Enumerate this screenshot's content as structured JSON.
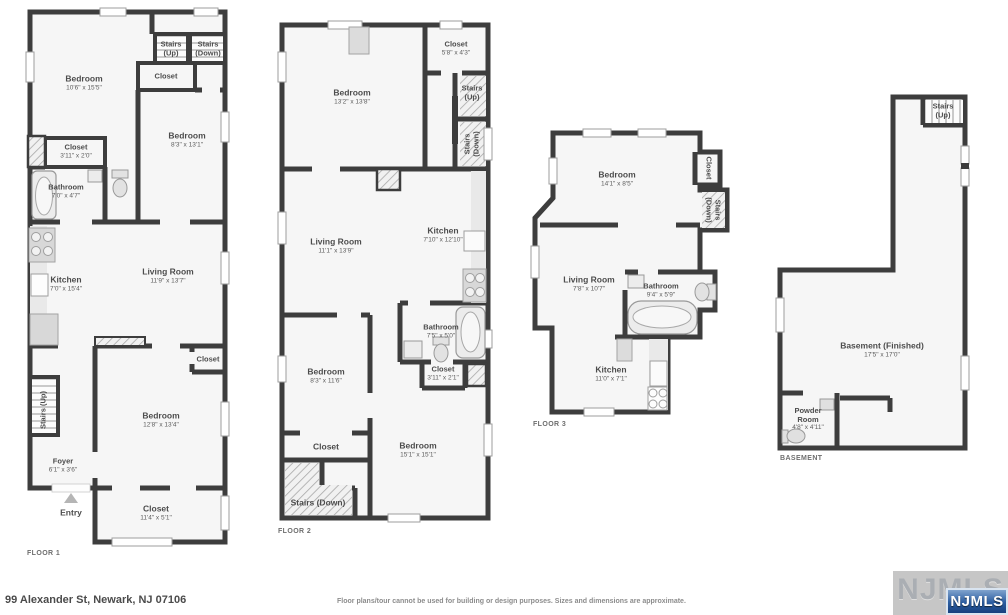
{
  "footer": {
    "address": "99 Alexander St, Newark, NJ 07106",
    "disclaimer": "Floor plans/tour cannot be used for building or design purposes. Sizes and dimensions are approximate.",
    "watermark": "NJMLS",
    "badge": "NJMLS"
  },
  "colors": {
    "wall": "#3d3d3d",
    "room_fill": "#f6f6f6",
    "badge_blue": "#2a5ca0",
    "watermark_gray": "#c6c6c6"
  },
  "floors": {
    "floor1": {
      "label": "FLOOR 1",
      "rooms": {
        "bedroom1": {
          "name": "Bedroom",
          "dims": "10'6\" x 15'5\""
        },
        "stairs_up_top": {
          "line1": "Stairs",
          "line2": "(Up)"
        },
        "stairs_down_top": {
          "line1": "Stairs",
          "line2": "(Down)"
        },
        "closet_top": {
          "name": "Closet"
        },
        "bedroom2": {
          "name": "Bedroom",
          "dims": "8'3\" x 13'1\""
        },
        "closet_left": {
          "name": "Closet",
          "dims": "3'11\" x 2'0\""
        },
        "bathroom": {
          "name": "Bathroom",
          "dims": "7'0\" x 4'7\""
        },
        "kitchen": {
          "name": "Kitchen",
          "dims": "7'0\" x 15'4\""
        },
        "living": {
          "name": "Living Room",
          "dims": "11'9\" x 13'7\""
        },
        "closet_mid": {
          "name": "Closet"
        },
        "stairs_up_side": {
          "name": "Stairs (Up)"
        },
        "bedroom3": {
          "name": "Bedroom",
          "dims": "12'8\" x 13'4\""
        },
        "foyer": {
          "name": "Foyer",
          "dims": "6'1\" x 3'6\""
        },
        "entry": {
          "name": "Entry"
        },
        "closet_bottom": {
          "name": "Closet",
          "dims": "11'4\" x 5'1\""
        }
      }
    },
    "floor2": {
      "label": "FLOOR 2",
      "rooms": {
        "bedroom1": {
          "name": "Bedroom",
          "dims": "13'2\" x 13'8\""
        },
        "closet1": {
          "name": "Closet",
          "dims": "5'8\" x 4'3\""
        },
        "stairs_up": {
          "line1": "Stairs",
          "line2": "(Up)"
        },
        "stairs_down": {
          "line1": "Stairs",
          "line2": "(Down)"
        },
        "living": {
          "name": "Living Room",
          "dims": "11'1\" x 13'9\""
        },
        "kitchen": {
          "name": "Kitchen",
          "dims": "7'10\" x 12'10\""
        },
        "bathroom": {
          "name": "Bathroom",
          "dims": "7'5\" x 5'0\""
        },
        "closet2": {
          "name": "Closet",
          "dims": "3'11\" x 2'1\""
        },
        "bedroom2": {
          "name": "Bedroom",
          "dims": "8'3\" x 11'6\""
        },
        "closet3": {
          "name": "Closet"
        },
        "bedroom3": {
          "name": "Bedroom",
          "dims": "15'1\" x 15'1\""
        },
        "stairs_down2": {
          "name": "Stairs (Down)"
        }
      }
    },
    "floor3": {
      "label": "FLOOR 3",
      "rooms": {
        "bedroom": {
          "name": "Bedroom",
          "dims": "14'1\" x 8'5\""
        },
        "closet": {
          "name": "Closet"
        },
        "stairs": {
          "line1": "Stairs",
          "line2": "(Down)"
        },
        "living": {
          "name": "Living Room",
          "dims": "7'8\" x 10'7\""
        },
        "bathroom": {
          "name": "Bathroom",
          "dims": "9'4\" x 5'9\""
        },
        "kitchen": {
          "name": "Kitchen",
          "dims": "11'0\" x 7'1\""
        }
      }
    },
    "basement": {
      "label": "BASEMENT",
      "rooms": {
        "stairs": {
          "line1": "Stairs",
          "line2": "(Up)"
        },
        "main": {
          "name": "Basement (Finished)",
          "dims": "17'5\" x 17'0\""
        },
        "powder": {
          "line1": "Powder",
          "line2": "Room",
          "dims": "4'8\" x 4'11\""
        }
      }
    }
  }
}
